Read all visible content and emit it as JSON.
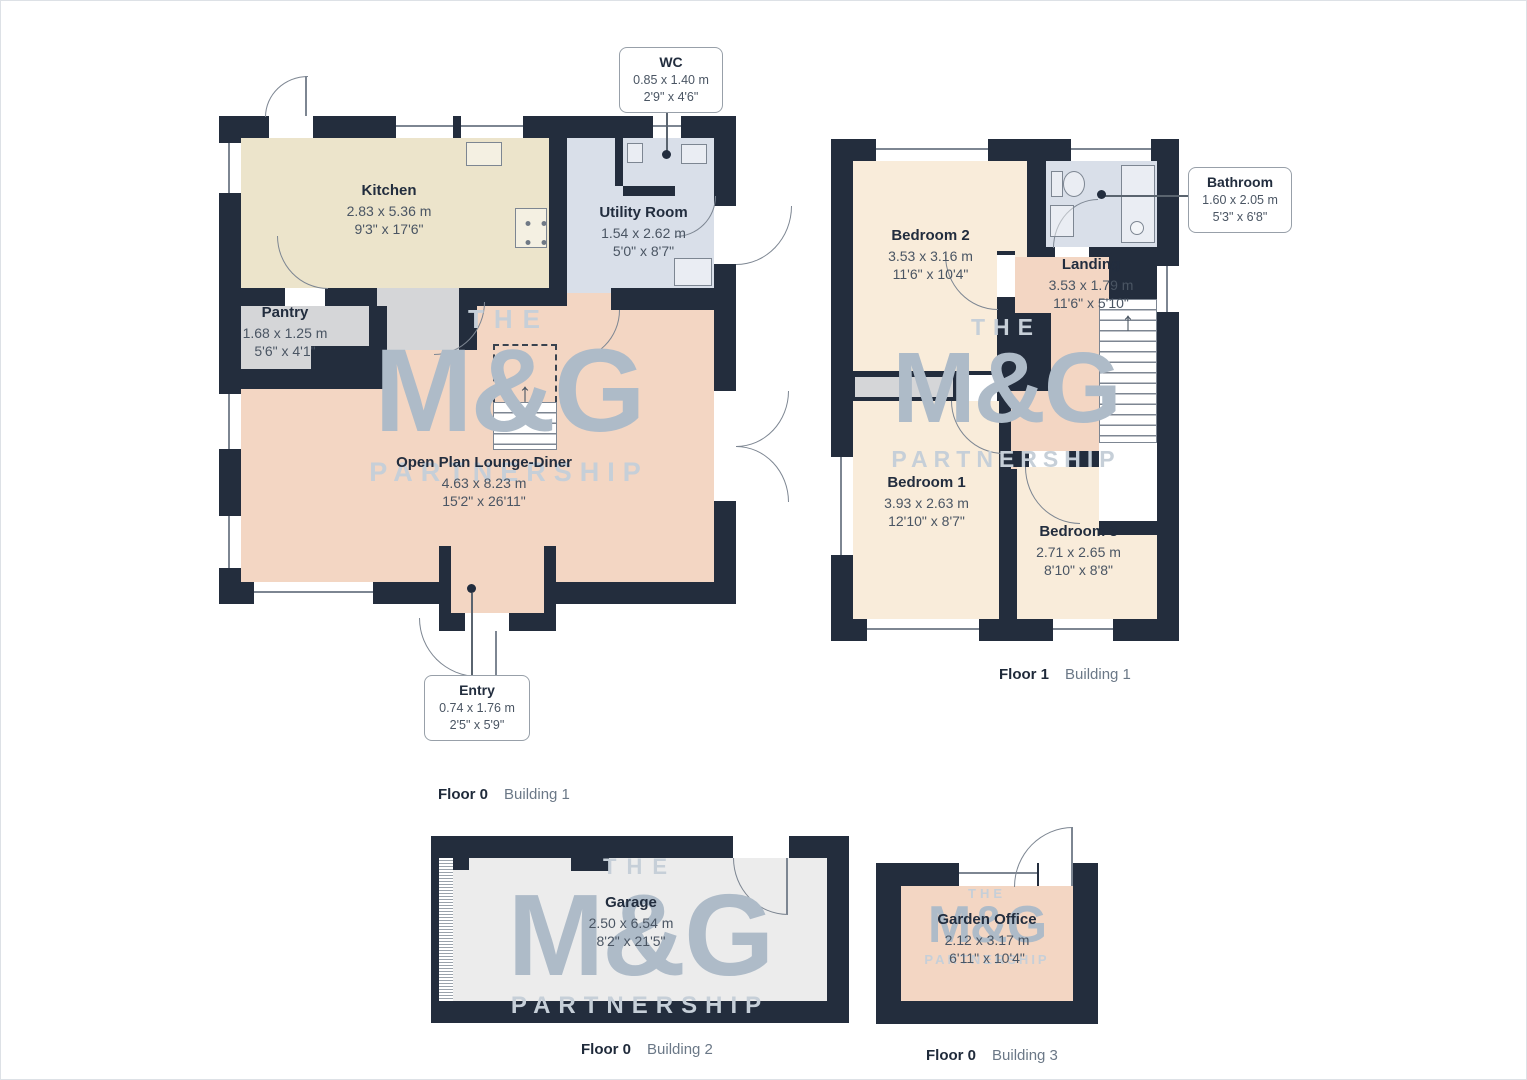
{
  "watermark": {
    "the": "THE",
    "mg": "M&G",
    "partnership": "PARTNERSHIP"
  },
  "icons": {
    "stairs_up_arrow": "↑"
  },
  "colors": {
    "wall": "#232d3d",
    "kitchen": "#ece4cb",
    "utility_bathroom": "#d9dfe9",
    "pantry": "#d5d6d8",
    "lounge_landing_office": "#f3d6c3",
    "bedroom": "#f9ecda",
    "garage": "#ececec",
    "watermark": "#aebbc8"
  },
  "floor0b1": {
    "caption": {
      "floor": "Floor 0",
      "building": "Building 1"
    },
    "kitchen": {
      "name": "Kitchen",
      "metric": "2.83 x 5.36 m",
      "imperial": "9'3\" x 17'6\""
    },
    "utility": {
      "name": "Utility Room",
      "metric": "1.54 x 2.62 m",
      "imperial": "5'0\" x 8'7\""
    },
    "pantry": {
      "name": "Pantry",
      "metric": "1.68 x 1.25 m",
      "imperial": "5'6\" x 4'1\""
    },
    "lounge": {
      "name": "Open Plan Lounge-Diner",
      "metric": "4.63 x 8.23 m",
      "imperial": "15'2\" x 26'11\""
    },
    "wc": {
      "name": "WC",
      "metric": "0.85 x 1.40 m",
      "imperial": "2'9\" x 4'6\""
    },
    "entry": {
      "name": "Entry",
      "metric": "0.74 x 1.76 m",
      "imperial": "2'5\" x 5'9\""
    }
  },
  "floor1b1": {
    "caption": {
      "floor": "Floor 1",
      "building": "Building 1"
    },
    "bedroom2": {
      "name": "Bedroom 2",
      "metric": "3.53 x 3.16 m",
      "imperial": "11'6\" x 10'4\""
    },
    "landing": {
      "name": "Landing",
      "metric": "3.53 x 1.79 m",
      "imperial": "11'6\" x 5'10\""
    },
    "bedroom1": {
      "name": "Bedroom 1",
      "metric": "3.93 x 2.63 m",
      "imperial": "12'10\" x 8'7\""
    },
    "bedroom3": {
      "name": "Bedroom 3",
      "metric": "2.71 x 2.65 m",
      "imperial": "8'10\" x 8'8\""
    },
    "bathroom": {
      "name": "Bathroom",
      "metric": "1.60 x 2.05 m",
      "imperial": "5'3\" x 6'8\""
    }
  },
  "floor0b2": {
    "caption": {
      "floor": "Floor 0",
      "building": "Building 2"
    },
    "garage": {
      "name": "Garage",
      "metric": "2.50 x 6.54 m",
      "imperial": "8'2\" x 21'5\""
    }
  },
  "floor0b3": {
    "caption": {
      "floor": "Floor 0",
      "building": "Building 3"
    },
    "office": {
      "name": "Garden Office",
      "metric": "2.12 x 3.17 m",
      "imperial": "6'11\" x 10'4\""
    }
  }
}
